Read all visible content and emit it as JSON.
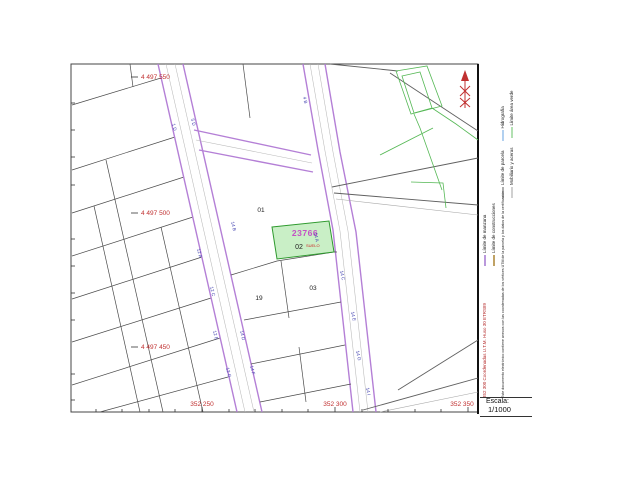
{
  "map": {
    "y_labels": [
      {
        "text": "4 497 550"
      },
      {
        "text": "4 497 500"
      },
      {
        "text": "4 497 450"
      }
    ],
    "x_labels": [
      {
        "text": "352 250"
      },
      {
        "text": "352 300"
      },
      {
        "text": "352 350"
      }
    ],
    "parcel_labels": [
      {
        "text": "01"
      },
      {
        "text": "19"
      },
      {
        "text": "03"
      }
    ],
    "highlight_parcel": {
      "ref": "23766",
      "number": "02",
      "land_tag": "SUELO"
    },
    "street_numbers": [
      {
        "text": "1 D"
      },
      {
        "text": "5 D"
      },
      {
        "text": "4 B"
      },
      {
        "text": "14 A"
      },
      {
        "text": "14 C"
      },
      {
        "text": "14 E"
      },
      {
        "text": "14 G"
      },
      {
        "text": "14 I"
      },
      {
        "text": "14 B"
      },
      {
        "text": "14 D"
      },
      {
        "text": "14 F"
      },
      {
        "text": "12 A"
      },
      {
        "text": "12 C"
      },
      {
        "text": "12 E"
      },
      {
        "text": "12 G"
      }
    ]
  },
  "legend": {
    "items": [
      {
        "label": "Límite de manzana",
        "color": "#a87fd4"
      },
      {
        "label": "Límite de construcciones",
        "color": "#b08a3e"
      },
      {
        "label": "Límite de parcela",
        "color": "#777777"
      },
      {
        "label": "Mobiliario y aceras",
        "color": "#b0b0b0"
      },
      {
        "label": "Hidrografía",
        "color": "#7fb2e5"
      },
      {
        "label": "Límite área verde",
        "color": "#7fcc7f"
      }
    ],
    "utm_note": "352 300 Coordenadas U.T.M. Huso 30 ETRS89",
    "disclaimer": "Este documento electrónico contiene anexos con las coordenadas de los vértices UTM de la parcela y los datos de la certificación",
    "scale_label": "Escala:",
    "scale_value": "1/1000"
  },
  "colors": {
    "road_purple": "#b47fd6",
    "parcel_line": "#4a4a4a",
    "highlight_fill": "#c9efc6",
    "highlight_border": "#2e9a2e",
    "ref_magenta": "#c44fc4",
    "coord_red": "#c03030",
    "street_blue": "#3f3fae",
    "green_area": "#55b855"
  }
}
